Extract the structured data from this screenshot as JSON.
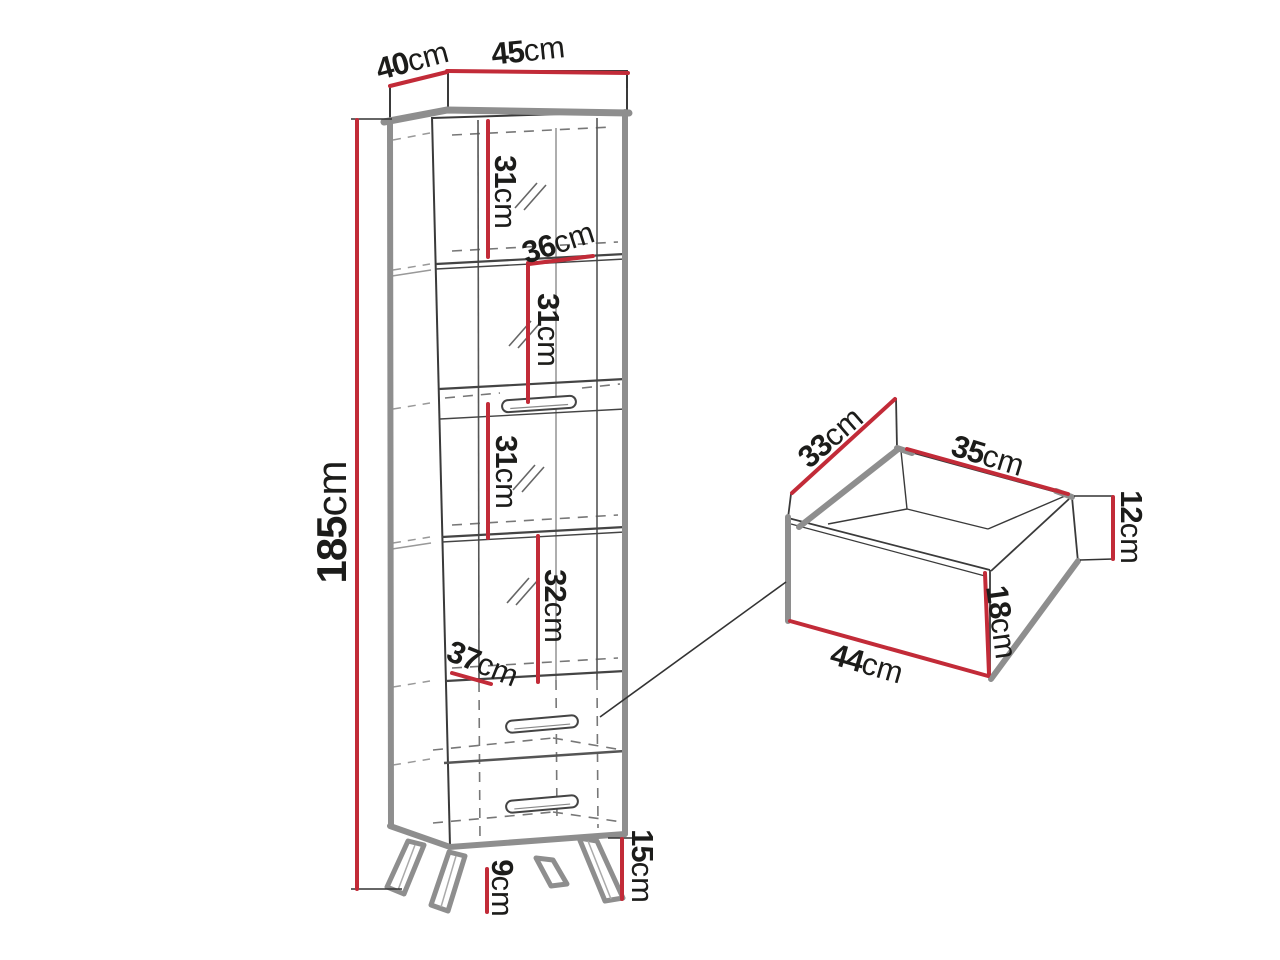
{
  "diagram": {
    "type": "furniture-dimension-drawing",
    "colors": {
      "dimension_line": "#c22b38",
      "panel_edge": "#8e8e8e",
      "outline": "#3a3a3a",
      "text": "#1c1c1a",
      "background": "#ffffff"
    },
    "cabinet": {
      "depth_top": {
        "num": "40",
        "unit": "cm"
      },
      "width_top": {
        "num": "45",
        "unit": "cm"
      },
      "height": {
        "num": "185",
        "unit": "cm"
      },
      "compartment_1": {
        "num": "31",
        "unit": "cm"
      },
      "inner_width": {
        "num": "36",
        "unit": "cm"
      },
      "compartment_2": {
        "num": "31",
        "unit": "cm"
      },
      "compartment_3": {
        "num": "31",
        "unit": "cm"
      },
      "compartment_4": {
        "num": "32",
        "unit": "cm"
      },
      "drawer_front_width": {
        "num": "37",
        "unit": "cm"
      },
      "plinth_height": {
        "num": "15",
        "unit": "cm"
      },
      "leg_height": {
        "num": "9",
        "unit": "cm"
      }
    },
    "drawer": {
      "depth": {
        "num": "33",
        "unit": "cm"
      },
      "inner_width": {
        "num": "35",
        "unit": "cm"
      },
      "side_height": {
        "num": "12",
        "unit": "cm"
      },
      "front_height": {
        "num": "18",
        "unit": "cm"
      },
      "front_width": {
        "num": "44",
        "unit": "cm"
      }
    }
  }
}
